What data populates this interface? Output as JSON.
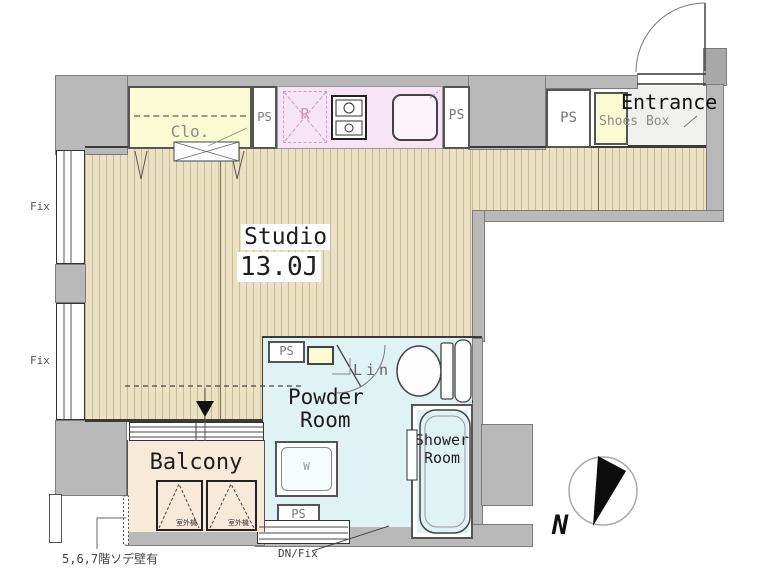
{
  "colors": {
    "wall": "#b9b9b9",
    "wood": "#ebe2c4",
    "yellow": "#fafbd2",
    "pink": "#f7e4f4",
    "cyan": "#dff2f4",
    "peach": "#f9e9d9",
    "tile": "#f0f0ee"
  },
  "rooms": {
    "studio": {
      "name": "Studio",
      "area": "13.0J"
    },
    "entrance": "Entrance",
    "shoes_box": "Shoes Box",
    "closet": "Clo.",
    "powder_room": {
      "line1": "Powder",
      "line2": "Room"
    },
    "shower_room": {
      "line1": "Shower",
      "line2": "Room"
    },
    "balcony": "Balcony",
    "linen": "Lin"
  },
  "labels": {
    "ps": "PS",
    "fix": "Fix",
    "dn_fix": "DN/Fix",
    "refrigerator": "R",
    "washer": "W",
    "north": "N",
    "outdoor_unit": "室外機",
    "note": "5,6,7階ソデ壁有"
  }
}
